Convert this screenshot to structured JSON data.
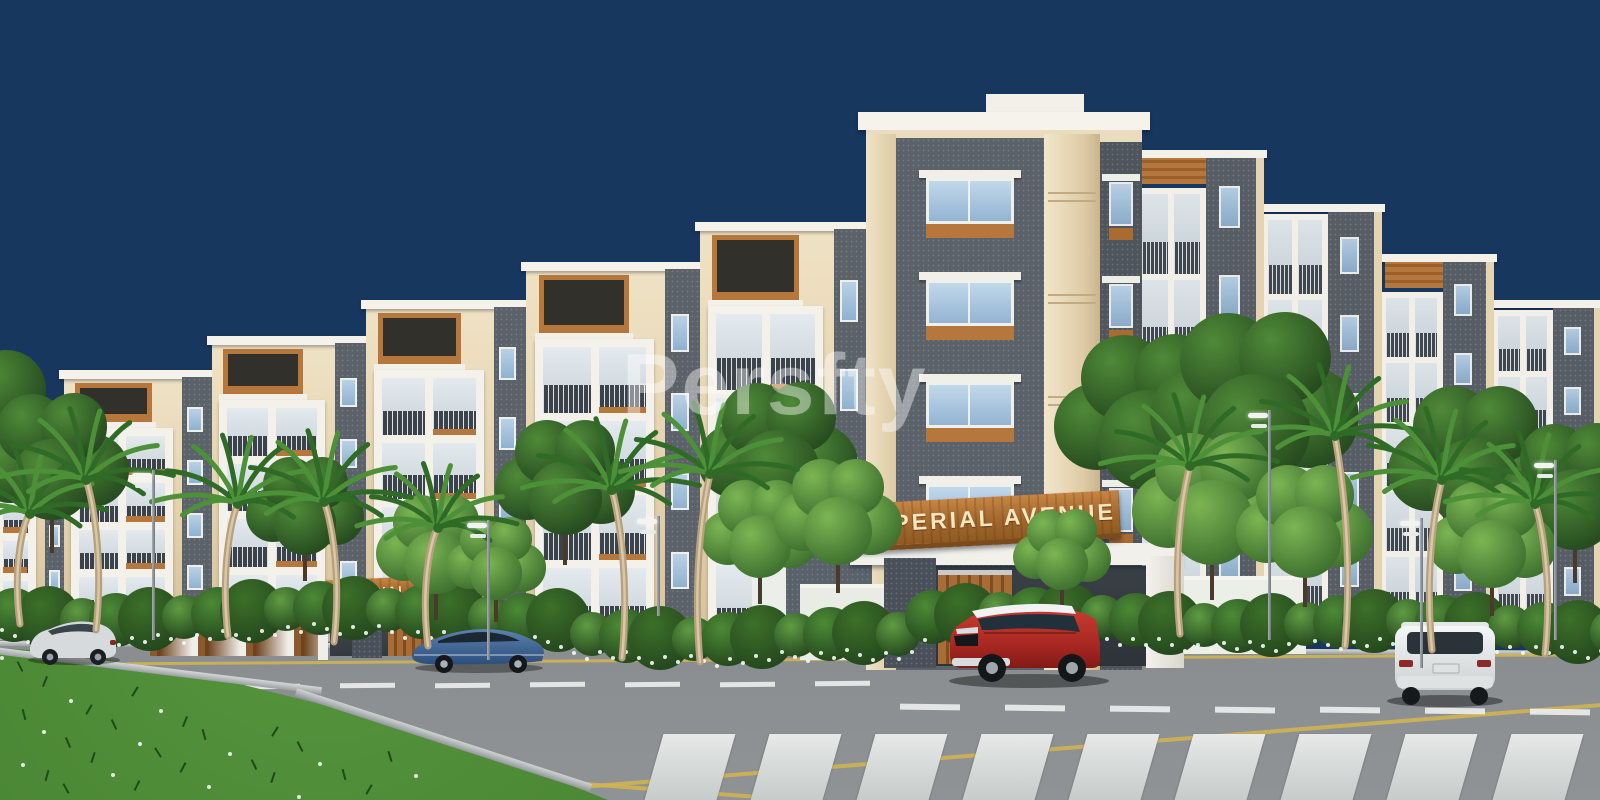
{
  "meta": {
    "description": "3D architectural rendering of a residential apartment complex at dusk, with entrance gates, landscaped road and cars"
  },
  "watermark": {
    "text": "Persfty"
  },
  "signs": {
    "main_gate_label": "IMPERIAL AVENUE",
    "left_gate_label": "IMPERIAL AVENUE"
  },
  "palette": {
    "sky": "#17375F",
    "wall_cream": "#EBDCBE",
    "wall_white": "#F4F1EA",
    "stone_gray": "#5B626A",
    "stone_gray_dark": "#4E555C",
    "wood_accent": "#B5773B",
    "sign_board": "#A96B2F",
    "sign_text": "#F6E7C2",
    "window_glass": "#A3BFD9",
    "railing_dark": "#2F363D",
    "foliage_dark": "#2E5B27",
    "foliage_light": "#5C9A3F",
    "road_asphalt": "#7D8184",
    "lane_yellow": "#D3B54E",
    "crosswalk_white": "#E2E5E4",
    "grass_green": "#3F7A2C"
  },
  "vehicles": [
    {
      "name": "silver-hatchback",
      "color": "#D5D8DA"
    },
    {
      "name": "blue-sedan",
      "color": "#44689A"
    },
    {
      "name": "red-suv-white-roof",
      "color": "#B5302B"
    },
    {
      "name": "white-suv",
      "color": "#ECEFF0"
    }
  ],
  "scenery": {
    "building_name": "Imperial Avenue apartment complex",
    "elements": [
      "left residential wing",
      "corner tower",
      "right residential wing",
      "main entrance portal",
      "secondary entrance",
      "palm trees",
      "hedges with white flowers",
      "street lamps",
      "asphalt road",
      "zebra crosswalk",
      "grass median"
    ]
  }
}
